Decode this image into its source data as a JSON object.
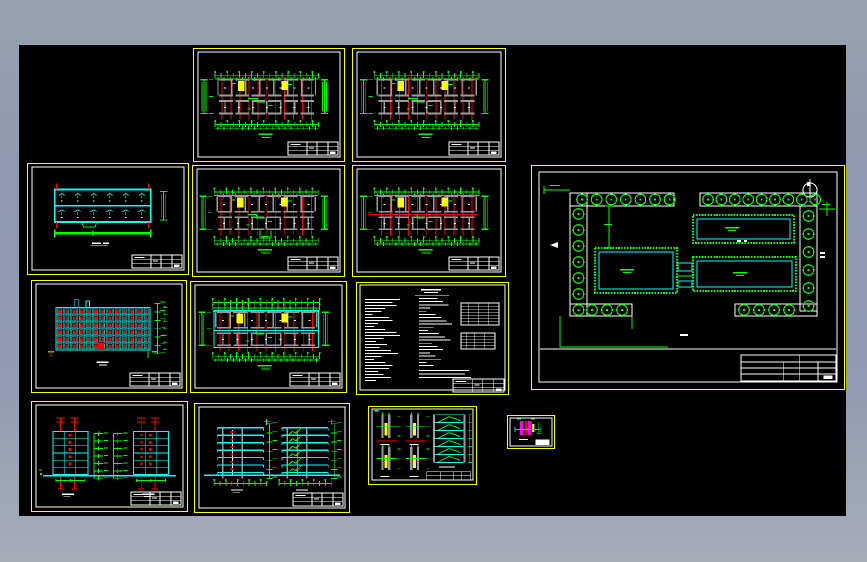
{
  "palette": {
    "bg_top": "#97a1b0",
    "bg_bottom": "#a7acb6",
    "canvas": "#000000",
    "frame": "#ffff00",
    "white": "#ffffff",
    "green": "#00ff00",
    "red": "#ff0000",
    "cyan": "#00ffff",
    "yellow": "#ffff00",
    "gray": "#9b9b9b",
    "magenta": "#ff00ff"
  },
  "canvas": {
    "x": 19,
    "y": 45,
    "w": 827,
    "h": 471
  },
  "sheets": [
    {
      "id": "floor-plan-a",
      "kind": "floorplan",
      "variant": "standard",
      "x": 193,
      "y": 48,
      "w": 152,
      "h": 114
    },
    {
      "id": "floor-plan-b",
      "kind": "floorplan",
      "variant": "standard",
      "x": 352,
      "y": 48,
      "w": 154,
      "h": 114
    },
    {
      "id": "roof-plan",
      "kind": "roofplan",
      "x": 27,
      "y": 163,
      "w": 162,
      "h": 112
    },
    {
      "id": "ground-floor-plan",
      "kind": "floorplan",
      "variant": "entrance",
      "x": 192,
      "y": 165,
      "w": 153,
      "h": 112
    },
    {
      "id": "floor-plan-c",
      "kind": "floorplan",
      "variant": "corridor",
      "x": 352,
      "y": 165,
      "w": 154,
      "h": 112
    },
    {
      "id": "front-elevation",
      "kind": "elevation",
      "x": 31,
      "y": 280,
      "w": 156,
      "h": 113
    },
    {
      "id": "floor-plan-d",
      "kind": "floorplan",
      "variant": "cyan",
      "x": 190,
      "y": 281,
      "w": 157,
      "h": 112
    },
    {
      "id": "design-notes",
      "kind": "notes",
      "x": 356,
      "y": 282,
      "w": 153,
      "h": 113
    },
    {
      "id": "side-elevations",
      "kind": "elevpair",
      "x": 31,
      "y": 401,
      "w": 157,
      "h": 111
    },
    {
      "id": "building-sections",
      "kind": "sections",
      "x": 194,
      "y": 403,
      "w": 156,
      "h": 110
    },
    {
      "id": "stair-details",
      "kind": "details",
      "x": 368,
      "y": 406,
      "w": 109,
      "h": 79
    },
    {
      "id": "node-detail",
      "kind": "tiny",
      "x": 507,
      "y": 415,
      "w": 48,
      "h": 34
    },
    {
      "id": "site-plan",
      "kind": "siteplan",
      "x": 531,
      "y": 165,
      "w": 314,
      "h": 225
    }
  ],
  "elevation": {
    "floors": 6,
    "window_cols": 13
  },
  "elevpair": {
    "floors": 6
  },
  "sections": {
    "levels": 6
  },
  "site": {
    "buildings": 3,
    "trees_top_left": 7,
    "trees_top_right": 9,
    "trees_left": 7,
    "trees_right": 6,
    "trees_bottom_left": 3,
    "trees_bottom_right": 4
  },
  "notes_lines": {
    "left": [
      38,
      30,
      34,
      22,
      18,
      8,
      26,
      30,
      14,
      10,
      22,
      34,
      38,
      20,
      12,
      24,
      16,
      28,
      36,
      18,
      10,
      22,
      30,
      26,
      14,
      20,
      28,
      12
    ],
    "middle": [
      20,
      26,
      32,
      12,
      8,
      18,
      24,
      30,
      36,
      16,
      10,
      22,
      28,
      34,
      14,
      20,
      26,
      12,
      18,
      24,
      8,
      16
    ],
    "middle_long": [
      50,
      46,
      52
    ]
  }
}
